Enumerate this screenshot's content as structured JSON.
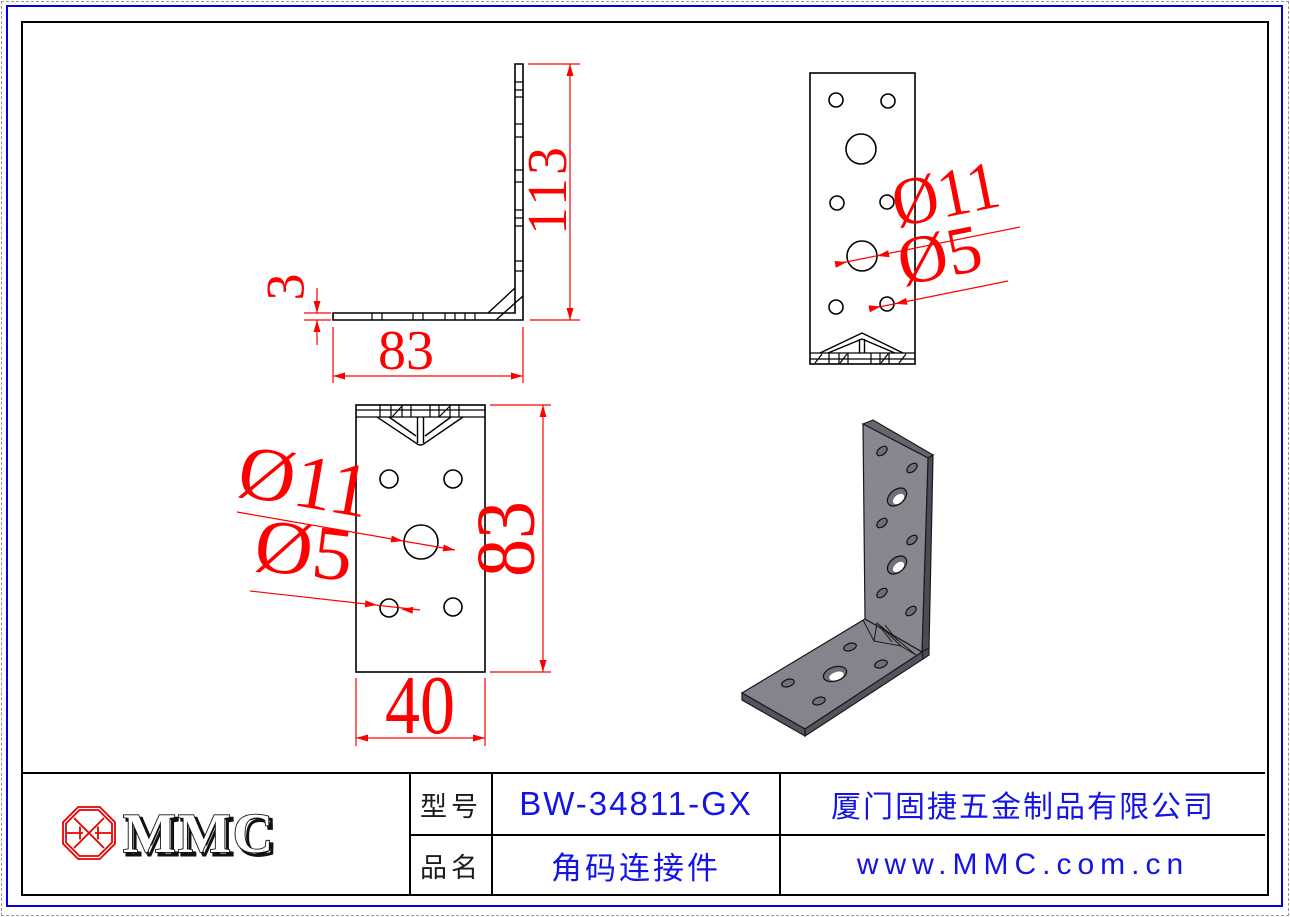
{
  "drawing": {
    "part": "L angle bracket with holes, three orthographic views and one isometric view",
    "dims": {
      "side_height": "113",
      "side_thickness": "3",
      "side_width": "83",
      "front_large": "Ø11",
      "front_small": "Ø5",
      "plan_large": "Ø11",
      "plan_small": "Ø5",
      "plan_length": "83",
      "plan_width": "40"
    }
  },
  "title_block": {
    "logo": "MMC",
    "model_label": "型号",
    "model_value": "BW-34811-GX",
    "name_label": "品名",
    "name_value": "角码连接件",
    "company": "厦门固捷五金制品有限公司",
    "website": "www.MMC.com.cn"
  },
  "colors": {
    "dimension_red": "#ff0000",
    "line_black": "#000000",
    "frame_blue": "#0000e0",
    "text_blue": "#1414e6",
    "logo_red": "#e50000",
    "iso_face": "#87878f",
    "iso_face_horizontal": "#84848c",
    "iso_edge_dark": "#54545f",
    "iso_edge_darker": "#4b4b56"
  }
}
